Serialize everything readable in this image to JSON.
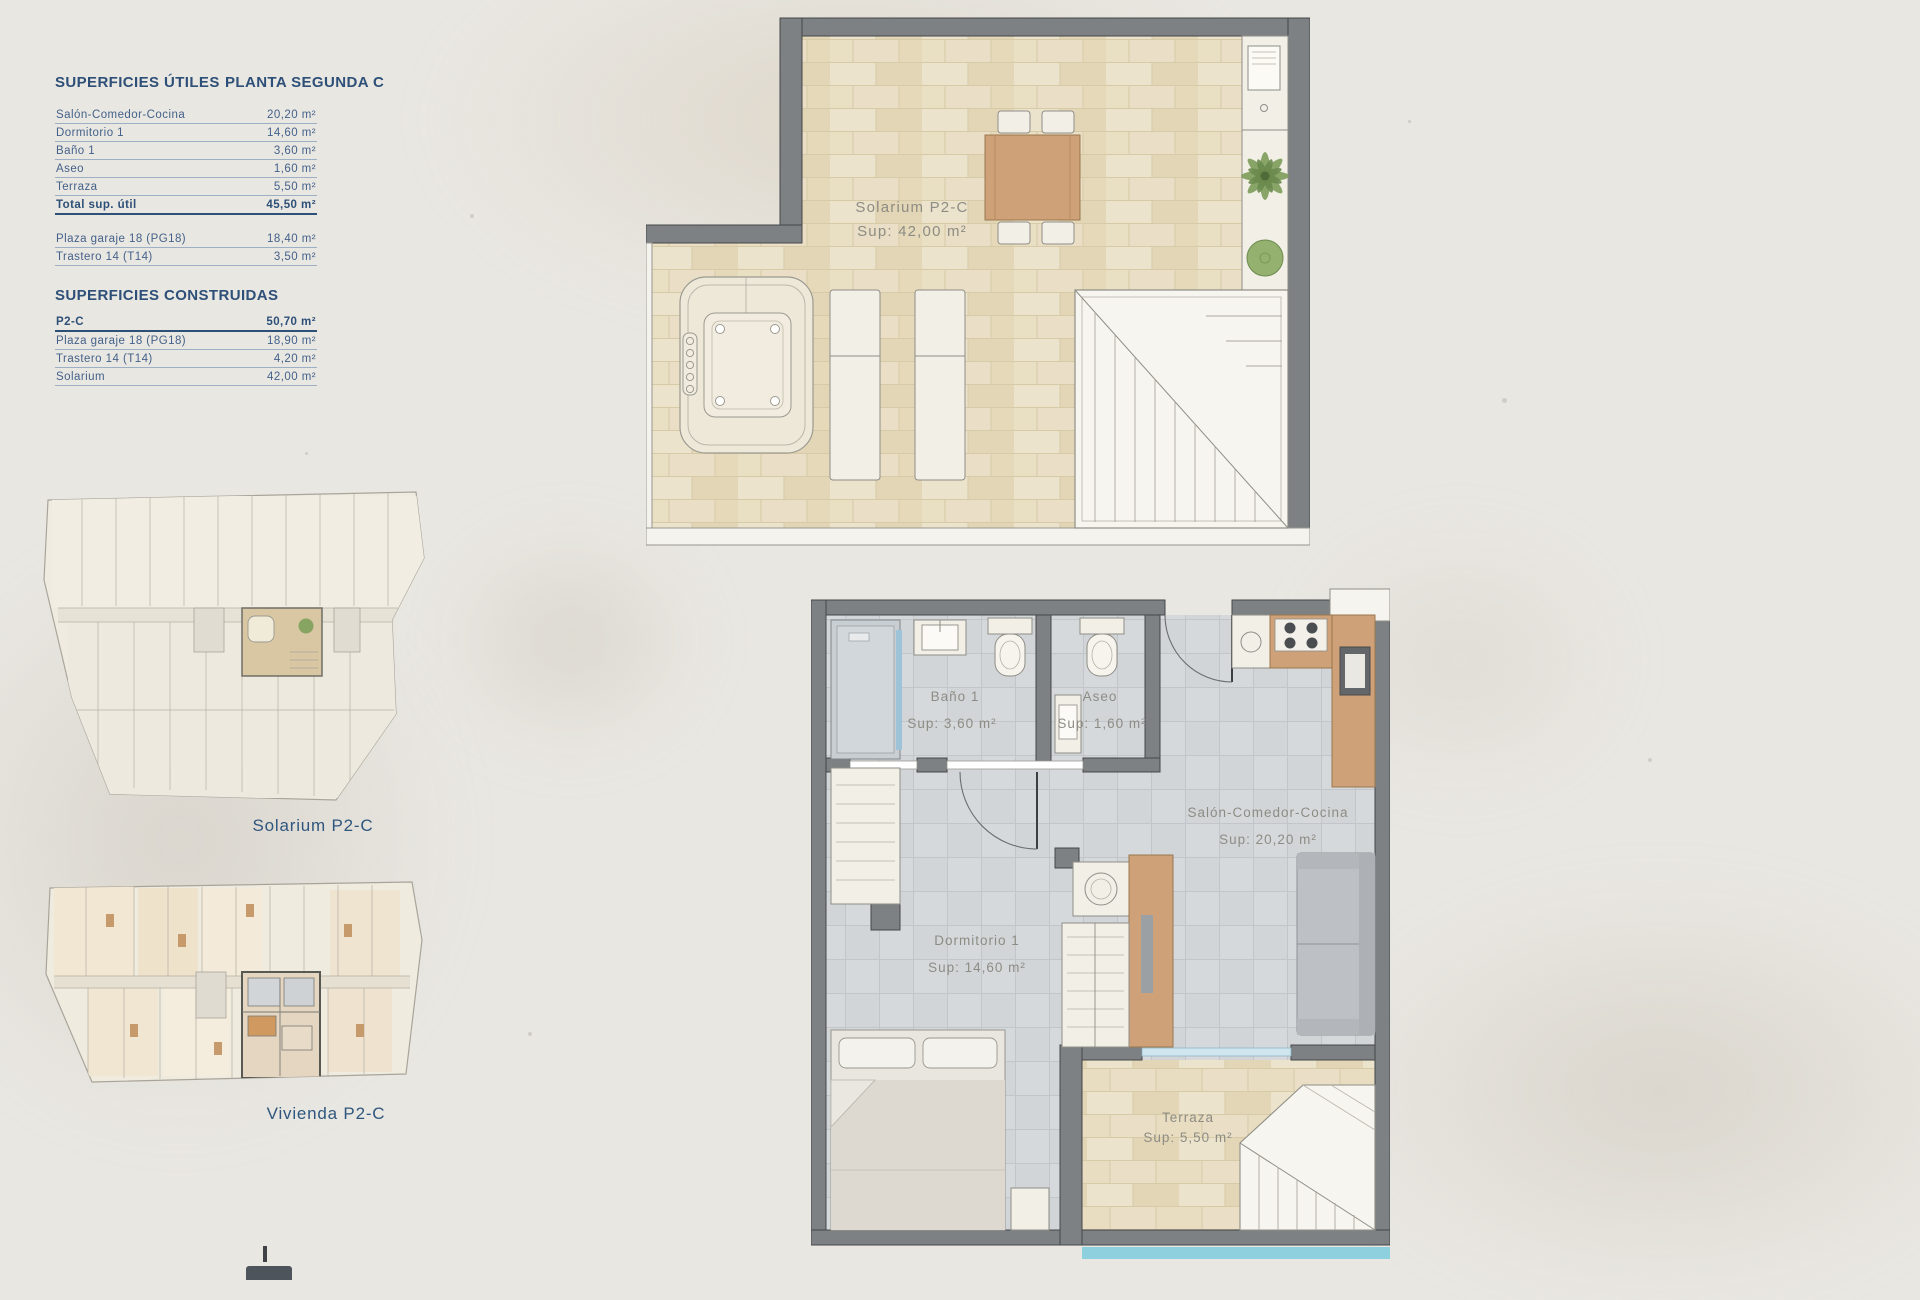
{
  "colors": {
    "accent_blue": "#2d4f78",
    "wall_gray": "#7d8184",
    "tile_beige": "#e7dcbf",
    "tile_gray": "#d2d5d8",
    "label_gray": "#8d8c84",
    "pool_blue": "#8fd0de"
  },
  "table": {
    "title": "SUPERFICIES ÚTILES",
    "plan_title": "PLANTA SEGUNDA C",
    "useful_rows": [
      {
        "label": "Salón-Comedor-Cocina",
        "value": "20,20 m²"
      },
      {
        "label": "Dormitorio 1",
        "value": "14,60 m²"
      },
      {
        "label": "Baño 1",
        "value": "3,60 m²"
      },
      {
        "label": "Aseo",
        "value": "1,60 m²"
      },
      {
        "label": "Terraza",
        "value": "5,50 m²"
      }
    ],
    "total_row": {
      "label": "Total sup. útil",
      "value": "45,50 m²"
    },
    "annex_rows": [
      {
        "label": "Plaza garaje 18 (PG18)",
        "value": "18,40 m²"
      },
      {
        "label": "Trastero 14 (T14)",
        "value": "3,50 m²"
      }
    ],
    "built_title": "SUPERFICIES CONSTRUIDAS",
    "built_rows": [
      {
        "label": "P2-C",
        "value": "50,70 m²"
      },
      {
        "label": "Plaza garaje 18 (PG18)",
        "value": "18,90 m²"
      },
      {
        "label": "Trastero 14 (T14)",
        "value": "4,20 m²"
      },
      {
        "label": "Solarium",
        "value": "42,00 m²"
      }
    ]
  },
  "mini_plans": {
    "solarium_label": "Solarium P2-C",
    "vivienda_label": "Vivienda P2-C"
  },
  "solarium": {
    "name": "Solarium P2-C",
    "sup": "Sup: 42,00 m²"
  },
  "apartment": {
    "bano": {
      "name": "Baño 1",
      "sup": "Sup: 3,60 m²"
    },
    "aseo": {
      "name": "Aseo",
      "sup": "Sup: 1,60 m²"
    },
    "salon": {
      "name": "Salón-Comedor-Cocina",
      "sup": "Sup: 20,20 m²"
    },
    "dormitorio": {
      "name": "Dormitorio 1",
      "sup": "Sup: 14,60 m²"
    },
    "terraza": {
      "name": "Terraza",
      "sup": "Sup: 5,50 m²"
    }
  }
}
